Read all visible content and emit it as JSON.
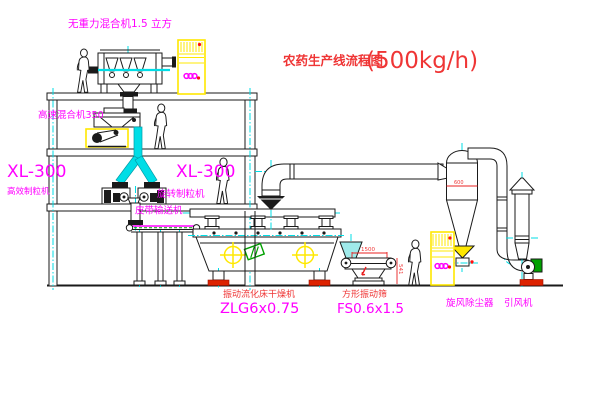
{
  "title": {
    "text": "农药生产线流程图",
    "capacity": "(500kg/h)"
  },
  "labels": {
    "top_mixer": "无重力混合机1.5 立方",
    "high_speed_mixer": "高速混合机350",
    "granulator_left_model": "XL-300",
    "granulator_left_name": "高效制粒机",
    "granulator_mid_model": "XL-300",
    "granulator_mid_name": "旋转制粒机",
    "belt_conveyor": "皮带输送机",
    "dryer_name": "振动流化床干燥机",
    "dryer_model": "ZLG6x0.75",
    "screen_name": "方形振动筛",
    "screen_model": "FS0.6x1.5",
    "cyclone": "旋风除尘器",
    "fan": "引风机"
  },
  "dimensions": {
    "screen_width": "1500",
    "screen_height": "541",
    "cyclone_dia": "600"
  },
  "colors": {
    "label_magenta": "#ff00ff",
    "label_red": "#ef3535",
    "line_black": "#1a1a1a",
    "pipe_cyan": "#00dde6",
    "cabinet_yellow": "#ffe800",
    "motor_green": "#00a000",
    "base_red": "#dd2200"
  }
}
